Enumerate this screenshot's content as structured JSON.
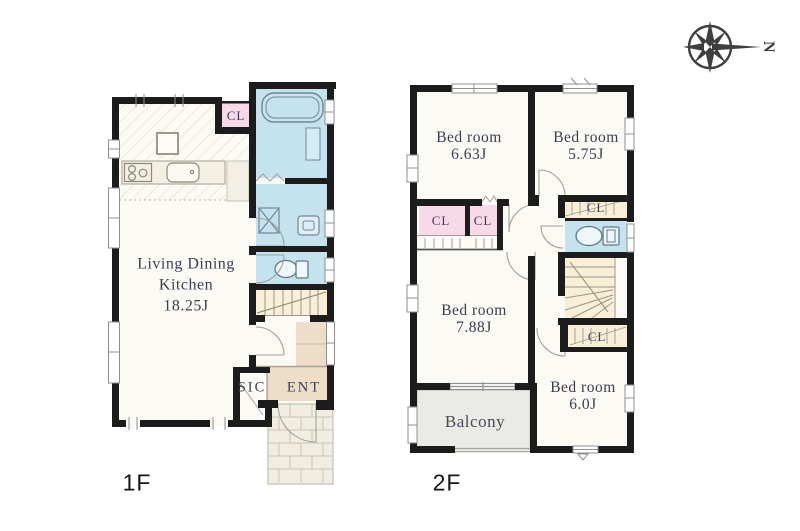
{
  "compass": {
    "north_label": "N"
  },
  "floor1": {
    "floor_label": "1F",
    "ldk": {
      "line1": "Living Dining",
      "line2": "Kitchen",
      "size": "18.25J"
    },
    "closet_label": "CL",
    "sic_label": "SIC",
    "ent_label": "ENT"
  },
  "floor2": {
    "floor_label": "2F",
    "bedroom_nw": {
      "name": "Bed room",
      "size": "6.63J"
    },
    "bedroom_ne": {
      "name": "Bed room",
      "size": "5.75J"
    },
    "bedroom_sw": {
      "name": "Bed room",
      "size": "7.88J"
    },
    "bedroom_se": {
      "name": "Bed room",
      "size": "6.0J"
    },
    "closet_left_label": "CL",
    "closet_right_label": "CL",
    "closet_ne_label": "CL",
    "closet_se_label": "CL",
    "balcony_label": "Balcony"
  },
  "colors": {
    "wall": "#1c1c1c",
    "floor": "#fcfaf4",
    "water_blue": "#c5e3ee",
    "closet_pink": "#f8d9e8",
    "stairs_beige": "#f8efd6",
    "balcony_gray": "#eaeae6",
    "entrance_tan": "#eeddc8",
    "porch": "#f1ede0",
    "label_text": "#3d3d52"
  }
}
